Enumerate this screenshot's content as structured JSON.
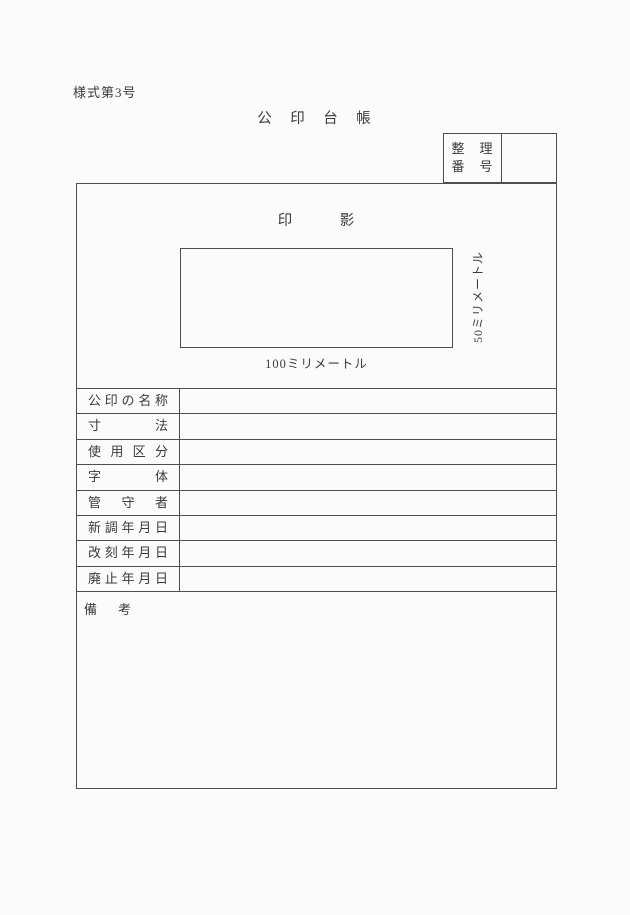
{
  "page": {
    "background_color": "#fbfbfb",
    "line_color": "#4e4e4e",
    "text_color": "#3b3b3b"
  },
  "header": {
    "form_number": "様式第3号",
    "title": "公　印　台　帳"
  },
  "reference_box": {
    "label_line1": "整　理",
    "label_line2": "番　号",
    "value": ""
  },
  "seal_section": {
    "heading": "印　　　影",
    "width_caption": "100ミリメートル",
    "height_caption": "50ミリメートル"
  },
  "table": {
    "rows": [
      {
        "label": "公印の名称",
        "value": ""
      },
      {
        "label": "寸法",
        "value": ""
      },
      {
        "label": "使用区分",
        "value": ""
      },
      {
        "label": "字体",
        "value": ""
      },
      {
        "label": "管守者",
        "value": ""
      },
      {
        "label": "新調年月日",
        "value": ""
      },
      {
        "label": "改刻年月日",
        "value": ""
      },
      {
        "label": "廃止年月日",
        "value": ""
      }
    ]
  },
  "remarks": {
    "label": "備　考",
    "value": ""
  }
}
